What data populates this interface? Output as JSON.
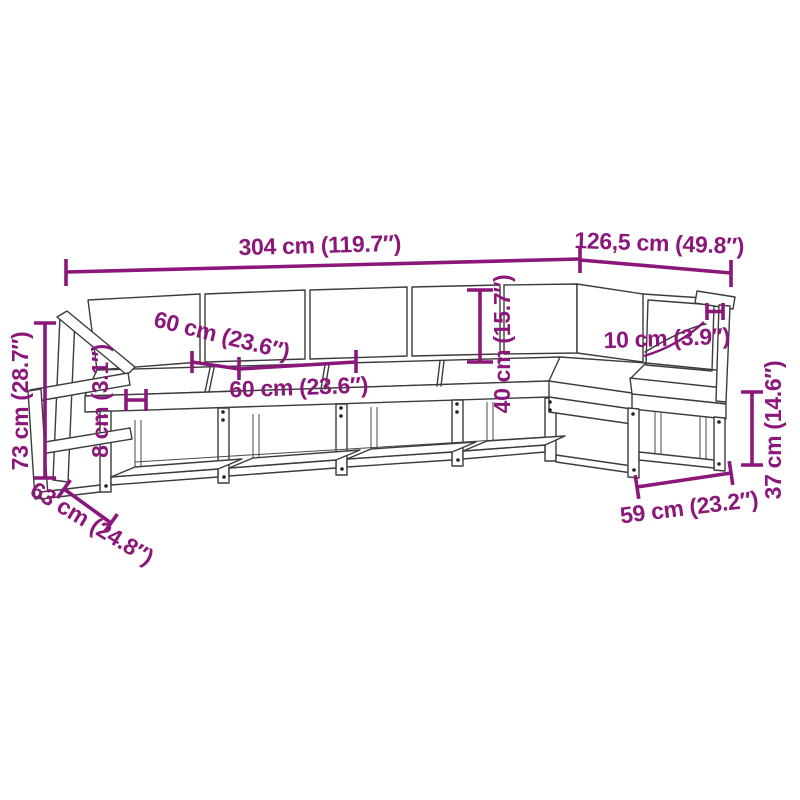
{
  "diagram": {
    "type": "product-dimension-line-drawing",
    "subject": "L-shaped wooden garden corner sofa set with back and seat cushions",
    "accent_color": "#8B177A",
    "drawing_color": "#3C3C3C",
    "background_color": "#FFFFFF",
    "labels": {
      "total_length": "304 cm (119.7″)",
      "side_section_length": "126,5 cm (49.8″)",
      "seat_depth": "60 cm (23.6″)",
      "seat_width": "60 cm (23.6″)",
      "cushion_thickness": "8 cm (3.1″)",
      "total_height": "73 cm (28.7″)",
      "overall_depth": "63 cm (24.8″)",
      "backrest_height": "40 cm (15.7″)",
      "armrest_width": "10 cm (3.9″)",
      "seat_frame_height": "37 cm (14.6″)",
      "front_seat_width": "59 cm (23.2″)"
    }
  }
}
